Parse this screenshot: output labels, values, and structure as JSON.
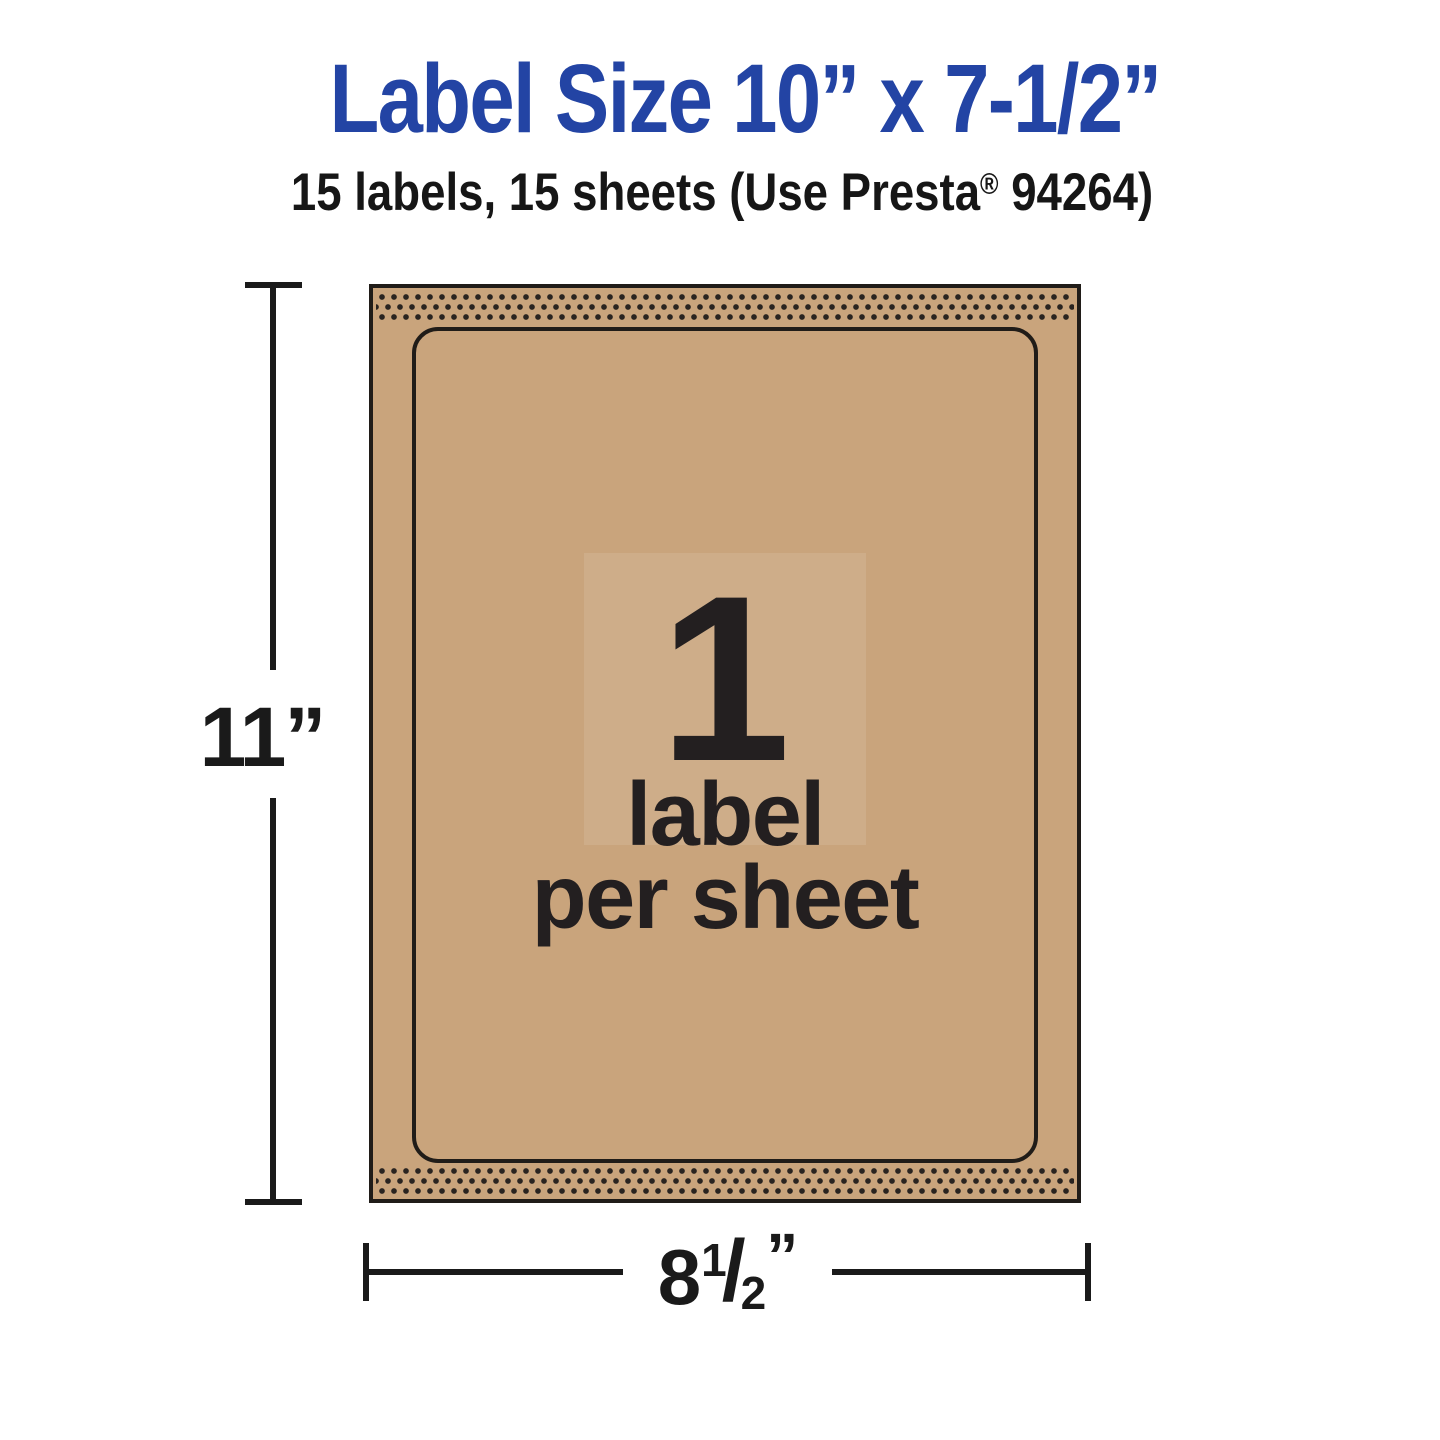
{
  "header": {
    "title": "Label Size 10” x 7-1/2”",
    "subtitle_pre": "15 labels, 15 sheets (Use Presta",
    "subtitle_reg_mark": "®",
    "subtitle_post": " 94264)"
  },
  "sheet": {
    "count": "1",
    "caption_line1": "label",
    "caption_line2": "per sheet"
  },
  "dimensions": {
    "height": "11”",
    "width_whole": "8",
    "width_numerator": "1",
    "width_slash": "/",
    "width_denominator": "2",
    "width_quote": "”"
  },
  "colors": {
    "title_blue": "#2344a4",
    "kraft_tan": "#c9a47c",
    "ink": "#231f20",
    "dimension_line": "#1a1a1a"
  }
}
